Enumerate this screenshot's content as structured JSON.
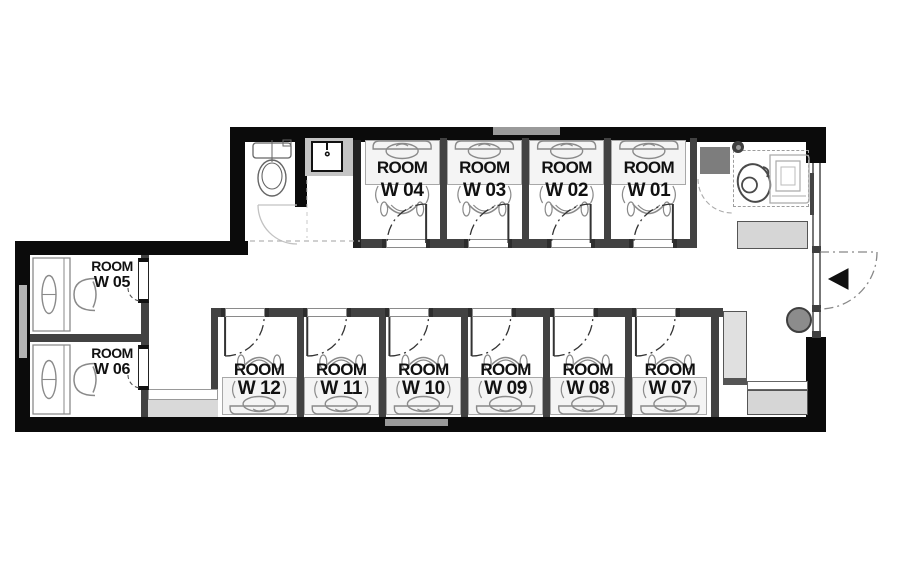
{
  "rooms": {
    "top": [
      {
        "label": "ROOM",
        "number": "W 04"
      },
      {
        "label": "ROOM",
        "number": "W 03"
      },
      {
        "label": "ROOM",
        "number": "W 02"
      },
      {
        "label": "ROOM",
        "number": "W 01"
      }
    ],
    "left": [
      {
        "label": "ROOM",
        "number": "W 05"
      },
      {
        "label": "ROOM",
        "number": "W 06"
      }
    ],
    "bottom": [
      {
        "label": "ROOM",
        "number": "W 12"
      },
      {
        "label": "ROOM",
        "number": "W 11"
      },
      {
        "label": "ROOM",
        "number": "W 10"
      },
      {
        "label": "ROOM",
        "number": "W 09"
      },
      {
        "label": "ROOM",
        "number": "W 08"
      },
      {
        "label": "ROOM",
        "number": "W 07"
      }
    ]
  },
  "fixtures": {
    "toilet": "toilet-icon",
    "sink": "sink-icon",
    "accessible_area": "accessible-toilet-icon",
    "entrance_arrow": "entrance-arrow-icon",
    "entrance_door": "entrance-door-swing",
    "column": "round-column",
    "bench_upper": "bench",
    "bench_lower": "bench",
    "cabinet": "tall-cabinet",
    "shelf": "dark-shelf",
    "mat": "floor-mat",
    "window": "window-strip"
  },
  "colors": {
    "wall": "#0b0b0b",
    "partition": "#424242",
    "label_band": "#f4f4f4",
    "band_border": "#a8a8a8",
    "furniture_light": "#d6d6d6",
    "furniture_dark": "#7d7d7d",
    "column": "#8c8c8c",
    "window": "#b3b3b3",
    "line_gray": "#8a8a8a",
    "door_line": "#333333",
    "floor": "#ffffff"
  }
}
